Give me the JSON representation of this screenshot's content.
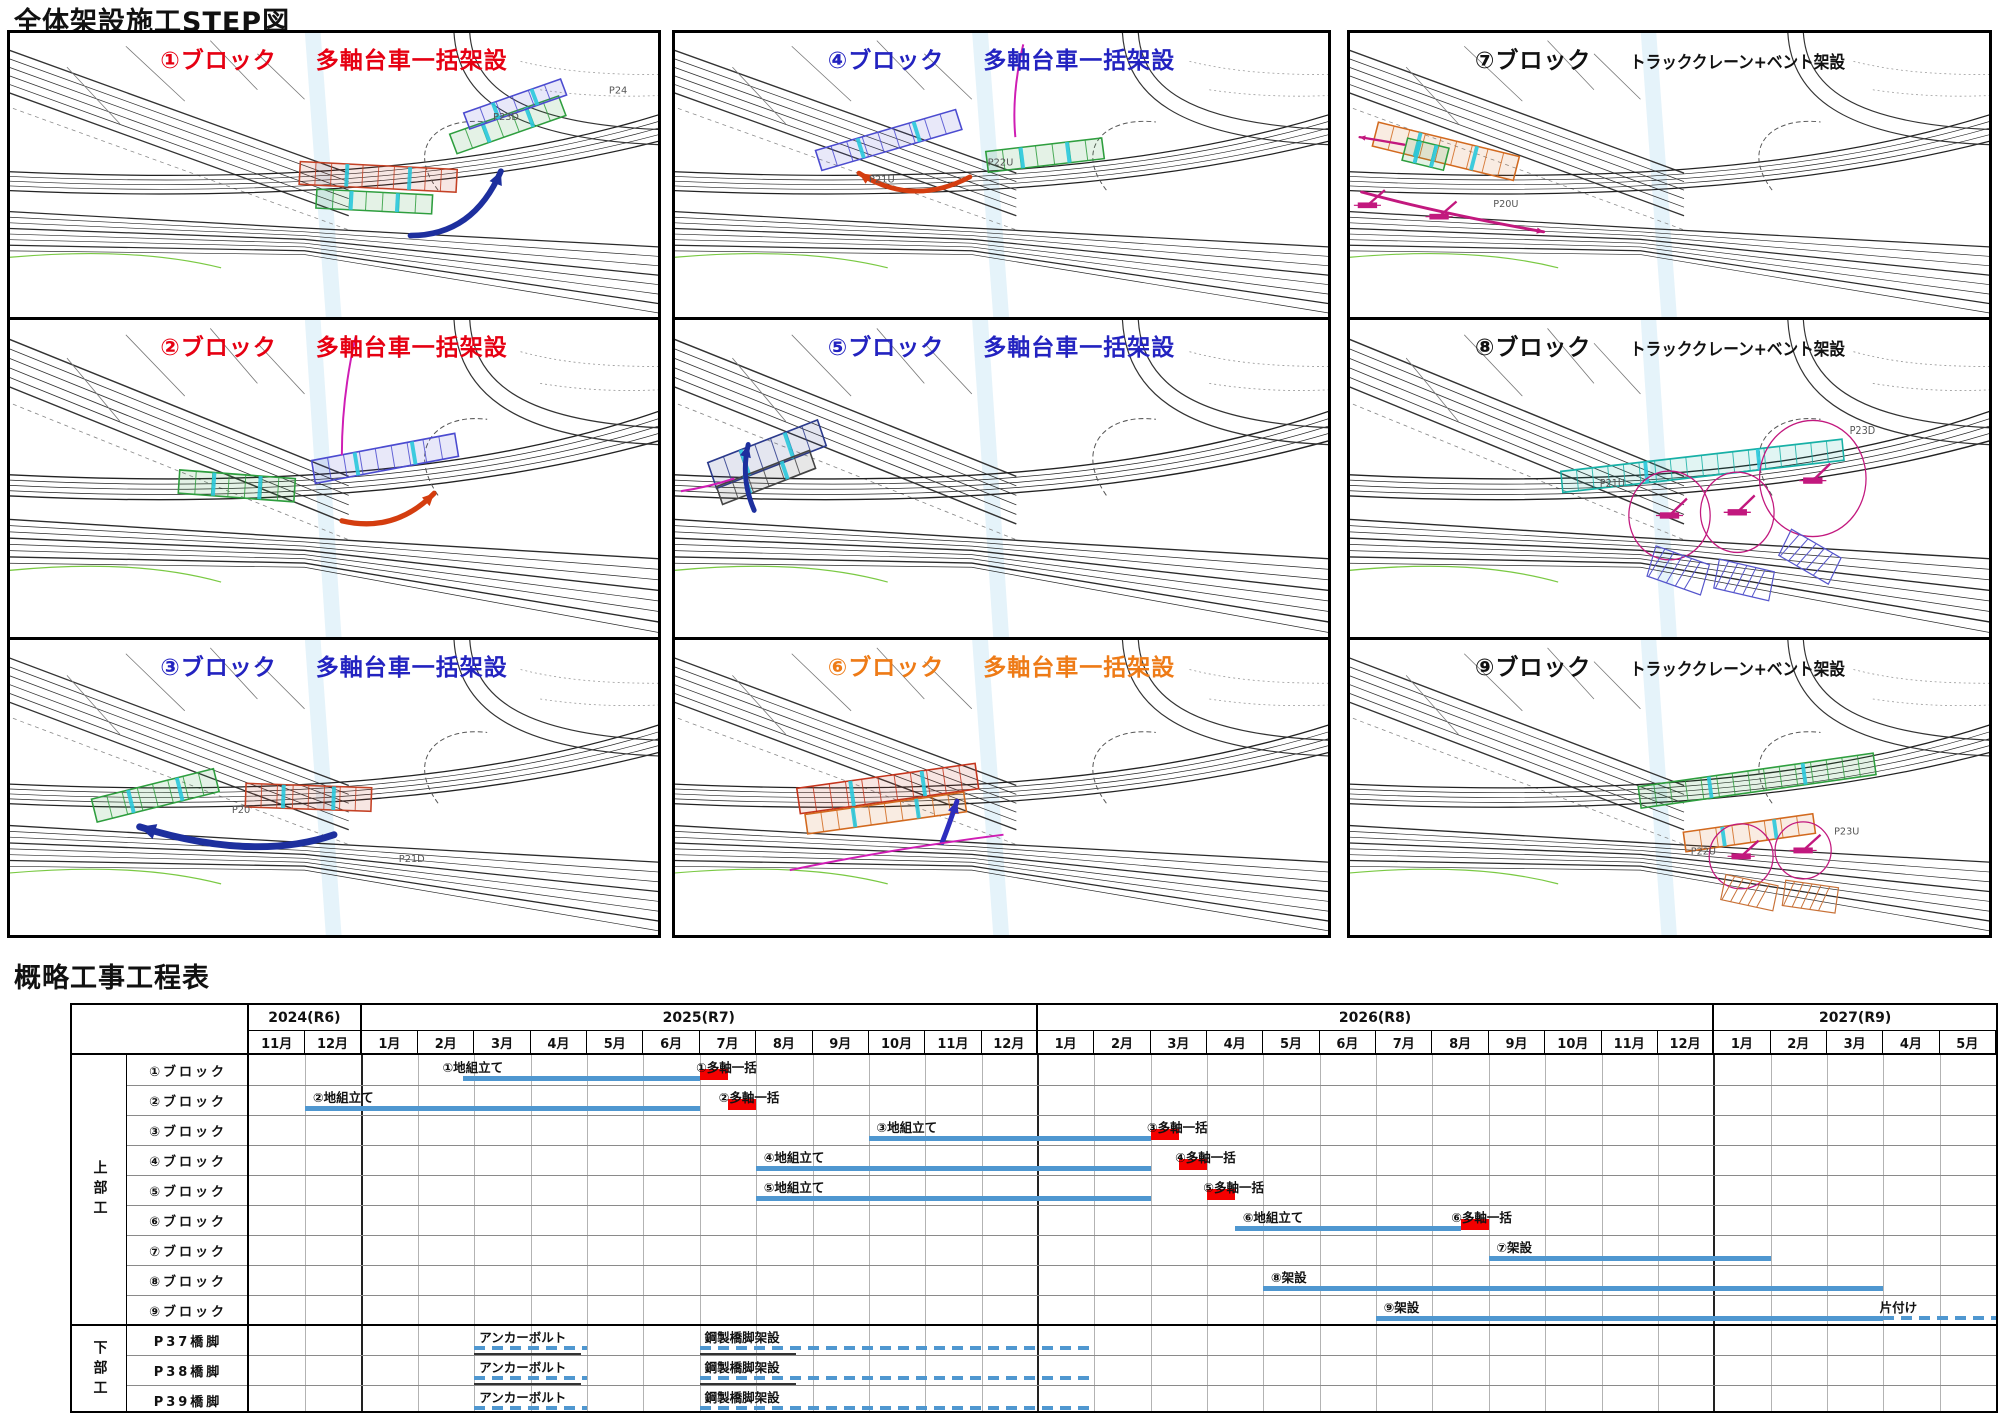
{
  "page": {
    "step_title": "全体架設施工STEP図",
    "gantt_title": "概略工事工程表"
  },
  "panels": [
    {
      "block_label": "①ブロック",
      "method": "多軸台車一括架設",
      "title_color": "#e60012",
      "piers": [
        {
          "t": "P23D",
          "x": 492,
          "y": 92
        },
        {
          "t": "P24",
          "x": 610,
          "y": 64
        }
      ],
      "features": [
        {
          "f": "girder",
          "x": 295,
          "y": 140,
          "w": 160,
          "h": 24,
          "a": 3,
          "c": "#c44125"
        },
        {
          "f": "girder",
          "x": 312,
          "y": 168,
          "w": 118,
          "h": 20,
          "a": 3,
          "c": "#2e9e3e"
        },
        {
          "f": "girder",
          "x": 448,
          "y": 86,
          "w": 118,
          "h": 22,
          "a": -20,
          "c": "#2e9e3e"
        },
        {
          "f": "girder",
          "x": 462,
          "y": 66,
          "w": 105,
          "h": 18,
          "a": -20,
          "c": "#4b4bd0"
        },
        {
          "f": "arrow",
          "x1": 408,
          "y1": 214,
          "cx": 472,
          "cy": 214,
          "x2": 500,
          "y2": 146,
          "c": "#1d2f9e",
          "sw": 6
        }
      ]
    },
    {
      "block_label": "②ブロック",
      "method": "多軸台車一括架設",
      "title_color": "#e60012",
      "piers": [],
      "features": [
        {
          "f": "girder",
          "x": 172,
          "y": 146,
          "w": 118,
          "h": 22,
          "a": 4,
          "c": "#2e9e3e"
        },
        {
          "f": "girder",
          "x": 308,
          "y": 120,
          "w": 148,
          "h": 22,
          "a": -10,
          "c": "#4b4bd0"
        },
        {
          "f": "curve",
          "x1": 352,
          "y1": 16,
          "cx": 338,
          "cy": 72,
          "x2": 338,
          "y2": 128,
          "c": "#cf1db4",
          "sw": 2
        },
        {
          "f": "arrow",
          "x1": 338,
          "y1": 190,
          "cx": 392,
          "cy": 202,
          "x2": 432,
          "y2": 164,
          "c": "#d43d0f",
          "sw": 5
        }
      ]
    },
    {
      "block_label": "③ブロック",
      "method": "多軸台車一括架設",
      "title_color": "#2323c0",
      "piers": [
        {
          "t": "P20",
          "x": 226,
          "y": 176
        },
        {
          "t": "P21D",
          "x": 396,
          "y": 226
        }
      ],
      "features": [
        {
          "f": "girder",
          "x": 84,
          "y": 146,
          "w": 128,
          "h": 24,
          "a": -14,
          "c": "#2e9e3e"
        },
        {
          "f": "girder",
          "x": 240,
          "y": 148,
          "w": 128,
          "h": 24,
          "a": 2,
          "c": "#c44125"
        },
        {
          "f": "arrow",
          "x1": 330,
          "y1": 198,
          "cx": 248,
          "cy": 226,
          "x2": 132,
          "y2": 190,
          "c": "#1d2f9e",
          "sw": 7
        }
      ]
    },
    {
      "block_label": "④ブロック",
      "method": "多軸台車一括架設",
      "title_color": "#2323c0",
      "piers": [
        {
          "t": "P21U",
          "x": 196,
          "y": 158
        },
        {
          "t": "P22U",
          "x": 316,
          "y": 140
        }
      ],
      "features": [
        {
          "f": "girder",
          "x": 142,
          "y": 102,
          "w": 148,
          "h": 22,
          "a": -17,
          "c": "#4b4bd0"
        },
        {
          "f": "girder",
          "x": 315,
          "y": 118,
          "w": 118,
          "h": 22,
          "a": -7,
          "c": "#2e9e3e"
        },
        {
          "f": "curve",
          "x1": 352,
          "y1": 12,
          "cx": 340,
          "cy": 64,
          "x2": 344,
          "y2": 110,
          "c": "#cf1db4",
          "sw": 2
        },
        {
          "f": "arrow",
          "x1": 298,
          "y1": 152,
          "cx": 240,
          "cy": 184,
          "x2": 186,
          "y2": 148,
          "c": "#d43d0f",
          "sw": 5
        }
      ]
    },
    {
      "block_label": "⑤ブロック",
      "method": "多軸台車一括架設",
      "title_color": "#2323c0",
      "piers": [],
      "features": [
        {
          "f": "girder",
          "x": 34,
          "y": 114,
          "w": 118,
          "h": 26,
          "a": -20,
          "c": "#2b3a8c"
        },
        {
          "f": "girder",
          "x": 42,
          "y": 140,
          "w": 100,
          "h": 18,
          "a": -20,
          "c": "#444444"
        },
        {
          "f": "arrow",
          "x1": 80,
          "y1": 180,
          "cx": 66,
          "cy": 150,
          "x2": 74,
          "y2": 118,
          "c": "#1d2f9e",
          "sw": 5
        },
        {
          "f": "curve",
          "x1": 6,
          "y1": 162,
          "cx": 34,
          "cy": 158,
          "x2": 60,
          "y2": 150,
          "c": "#cf1db4",
          "sw": 2
        }
      ]
    },
    {
      "block_label": "⑥ブロック",
      "method": "多軸台車一括架設",
      "title_color": "#ee7b17",
      "piers": [],
      "features": [
        {
          "f": "girder",
          "x": 124,
          "y": 138,
          "w": 182,
          "h": 26,
          "a": -8,
          "c": "#c4341c"
        },
        {
          "f": "girder",
          "x": 132,
          "y": 166,
          "w": 162,
          "h": 20,
          "a": -8,
          "c": "#d2691e"
        },
        {
          "f": "arrow",
          "x1": 270,
          "y1": 206,
          "cx": 277,
          "cy": 188,
          "x2": 285,
          "y2": 164,
          "c": "#2d2dbe",
          "sw": 5
        },
        {
          "f": "curve",
          "x1": 116,
          "y1": 234,
          "cx": 222,
          "cy": 212,
          "x2": 332,
          "y2": 198,
          "c": "#cf1db4",
          "sw": 2
        }
      ]
    },
    {
      "block_label": "⑦ブロック",
      "method": "トラッククレーン+ベント架設",
      "title_color": "#111111",
      "piers": [
        {
          "t": "P20U",
          "x": 148,
          "y": 184
        }
      ],
      "features": [
        {
          "f": "girder",
          "x": 24,
          "y": 112,
          "w": 150,
          "h": 26,
          "a": 14,
          "c": "#d2691e"
        },
        {
          "f": "girder",
          "x": 56,
          "y": 116,
          "w": 44,
          "h": 24,
          "a": 14,
          "c": "#2e9e3e"
        },
        {
          "f": "crane",
          "x": 18,
          "y": 182,
          "c": "#c2187e"
        },
        {
          "f": "crane",
          "x": 92,
          "y": 194,
          "c": "#c2187e"
        },
        {
          "f": "arrow",
          "x1": 56,
          "y1": 118,
          "cx": 34,
          "cy": 114,
          "x2": 10,
          "y2": 110,
          "c": "#c2187e",
          "sw": 2.5
        },
        {
          "f": "arrow",
          "x1": 12,
          "y1": 168,
          "cx": 90,
          "cy": 190,
          "x2": 200,
          "y2": 210,
          "c": "#c2187e",
          "sw": 3
        }
      ]
    },
    {
      "block_label": "⑧ブロック",
      "method": "トラッククレーン+ベント架設",
      "title_color": "#111111",
      "piers": [
        {
          "t": "P21U",
          "x": 258,
          "y": 158
        },
        {
          "t": "P23D",
          "x": 516,
          "y": 108
        }
      ],
      "features": [
        {
          "f": "girder",
          "x": 218,
          "y": 128,
          "w": 292,
          "h": 20,
          "a": -6,
          "c": "#17b0a6"
        },
        {
          "f": "circle",
          "x": 330,
          "y": 185,
          "r": 42,
          "c": "#c2187e"
        },
        {
          "f": "circle",
          "x": 400,
          "y": 182,
          "r": 38,
          "c": "#c2187e"
        },
        {
          "f": "circle",
          "x": 478,
          "y": 150,
          "r": 55,
          "c": "#c2187e"
        },
        {
          "f": "crane",
          "x": 330,
          "y": 185,
          "c": "#c2187e"
        },
        {
          "f": "crane",
          "x": 400,
          "y": 182,
          "c": "#c2187e"
        },
        {
          "f": "crane",
          "x": 478,
          "y": 152,
          "c": "#c2187e"
        },
        {
          "f": "hatch",
          "x": 310,
          "y": 222,
          "w": 58,
          "h": 30,
          "a": 18,
          "c": "#5555cc"
        },
        {
          "f": "hatch",
          "x": 378,
          "y": 232,
          "w": 58,
          "h": 28,
          "a": 12,
          "c": "#5555cc"
        },
        {
          "f": "hatch",
          "x": 446,
          "y": 210,
          "w": 58,
          "h": 28,
          "a": 28,
          "c": "#5555cc"
        }
      ]
    },
    {
      "block_label": "⑨ブロック",
      "method": "トラッククレーン+ベント架設",
      "title_color": "#111111",
      "piers": [
        {
          "t": "P22U",
          "x": 352,
          "y": 218
        },
        {
          "t": "P23U",
          "x": 500,
          "y": 198
        }
      ],
      "features": [
        {
          "f": "girder",
          "x": 298,
          "y": 132,
          "w": 245,
          "h": 22,
          "a": -8,
          "c": "#2e9e3e"
        },
        {
          "f": "girder",
          "x": 345,
          "y": 186,
          "w": 135,
          "h": 20,
          "a": -8,
          "c": "#d2691e"
        },
        {
          "f": "circle",
          "x": 404,
          "y": 220,
          "r": 33,
          "c": "#c2187e"
        },
        {
          "f": "circle",
          "x": 468,
          "y": 214,
          "r": 29,
          "c": "#c2187e"
        },
        {
          "f": "crane",
          "x": 404,
          "y": 220,
          "c": "#c2187e"
        },
        {
          "f": "crane",
          "x": 468,
          "y": 214,
          "c": "#c2187e"
        },
        {
          "f": "hatch",
          "x": 385,
          "y": 244,
          "w": 55,
          "h": 26,
          "a": 12,
          "c": "#c87137"
        },
        {
          "f": "hatch",
          "x": 448,
          "y": 248,
          "w": 55,
          "h": 26,
          "a": 8,
          "c": "#c87137"
        }
      ]
    }
  ],
  "gantt": {
    "years": [
      {
        "label": "2024(R6)",
        "months": [
          "11月",
          "12月"
        ]
      },
      {
        "label": "2025(R7)",
        "months": [
          "1月",
          "2月",
          "3月",
          "4月",
          "5月",
          "6月",
          "7月",
          "8月",
          "9月",
          "10月",
          "11月",
          "12月"
        ]
      },
      {
        "label": "2026(R8)",
        "months": [
          "1月",
          "2月",
          "3月",
          "4月",
          "5月",
          "6月",
          "7月",
          "8月",
          "9月",
          "10月",
          "11月",
          "12月"
        ]
      },
      {
        "label": "2027(R9)",
        "months": [
          "1月",
          "2月",
          "3月",
          "4月",
          "5月"
        ]
      }
    ],
    "sections": [
      {
        "label": "上部工",
        "rows": [
          {
            "label": "①ブロック",
            "bars": [
              {
                "kind": "solid",
                "start": 3.8,
                "end": 8,
                "label": "①地組立て",
                "label_at": 3.4
              },
              {
                "kind": "red",
                "start": 8,
                "end": 8.5,
                "label": "①多軸一括",
                "label_at": 7.9
              }
            ]
          },
          {
            "label": "②ブロック",
            "bars": [
              {
                "kind": "solid",
                "start": 1,
                "end": 8,
                "label": "②地組立て",
                "label_at": 1.1
              },
              {
                "kind": "red",
                "start": 8.5,
                "end": 9,
                "label": "②多軸一括",
                "label_at": 8.3
              }
            ]
          },
          {
            "label": "③ブロック",
            "bars": [
              {
                "kind": "solid",
                "start": 11,
                "end": 16,
                "label": "③地組立て",
                "label_at": 11.1
              },
              {
                "kind": "red",
                "start": 16,
                "end": 16.5,
                "label": "③多軸一括",
                "label_at": 15.9
              }
            ]
          },
          {
            "label": "④ブロック",
            "bars": [
              {
                "kind": "solid",
                "start": 9,
                "end": 16,
                "label": "④地組立て",
                "label_at": 9.1
              },
              {
                "kind": "red",
                "start": 16.5,
                "end": 17,
                "label": "④多軸一括",
                "label_at": 16.4
              }
            ]
          },
          {
            "label": "⑤ブロック",
            "bars": [
              {
                "kind": "solid",
                "start": 9,
                "end": 16,
                "label": "⑤地組立て",
                "label_at": 9.1
              },
              {
                "kind": "red",
                "start": 17,
                "end": 17.5,
                "label": "⑤多軸一括",
                "label_at": 16.9
              }
            ]
          },
          {
            "label": "⑥ブロック",
            "bars": [
              {
                "kind": "solid",
                "start": 17.5,
                "end": 21.5,
                "label": "⑥地組立て",
                "label_at": 17.6
              },
              {
                "kind": "red",
                "start": 21.5,
                "end": 22,
                "label": "⑥多軸一括",
                "label_at": 21.3
              }
            ]
          },
          {
            "label": "⑦ブロック",
            "bars": [
              {
                "kind": "solid",
                "start": 22,
                "end": 27,
                "label": "⑦架設",
                "label_at": 22.1
              }
            ]
          },
          {
            "label": "⑧ブロック",
            "bars": [
              {
                "kind": "solid",
                "start": 18,
                "end": 29,
                "label": "⑧架設",
                "label_at": 18.1
              }
            ]
          },
          {
            "label": "⑨ブロック",
            "bars": [
              {
                "kind": "solid",
                "start": 20,
                "end": 29,
                "label": "⑨架設",
                "label_at": 20.1
              },
              {
                "kind": "dashed",
                "start": 29,
                "end": 31,
                "label": "片付け",
                "label_at": 28.9
              }
            ]
          }
        ]
      },
      {
        "label": "下部工",
        "rows": [
          {
            "label": "P37橋脚",
            "bars": [
              {
                "kind": "dashed",
                "start": 4,
                "end": 6,
                "label": "アンカーボルト",
                "label_at": 4.05
              },
              {
                "kind": "dashed",
                "start": 8,
                "end": 15,
                "label": "鋼製橋脚架設",
                "label_at": 8.05
              }
            ],
            "marks": [
              [
                4,
                5.9
              ],
              [
                8,
                9.7
              ]
            ]
          },
          {
            "label": "P38橋脚",
            "bars": [
              {
                "kind": "dashed",
                "start": 4,
                "end": 6,
                "label": "アンカーボルト",
                "label_at": 4.05
              },
              {
                "kind": "dashed",
                "start": 8,
                "end": 15,
                "label": "鋼製橋脚架設",
                "label_at": 8.05
              }
            ],
            "marks": [
              [
                4,
                5.9
              ],
              [
                8,
                9.7
              ]
            ]
          },
          {
            "label": "P39橋脚",
            "bars": [
              {
                "kind": "dashed",
                "start": 4,
                "end": 6,
                "label": "アンカーボルト",
                "label_at": 4.05
              },
              {
                "kind": "dashed",
                "start": 8,
                "end": 15,
                "label": "鋼製橋脚架設",
                "label_at": 8.05
              }
            ],
            "marks": []
          }
        ]
      }
    ],
    "colors": {
      "solid": "#4f97d0",
      "red": "#f40000",
      "dashed": "#4f97d0",
      "grid": "#b3b3b3",
      "year_line": "#222222",
      "row_line": "#8a8a8a",
      "border": "#000000"
    }
  }
}
